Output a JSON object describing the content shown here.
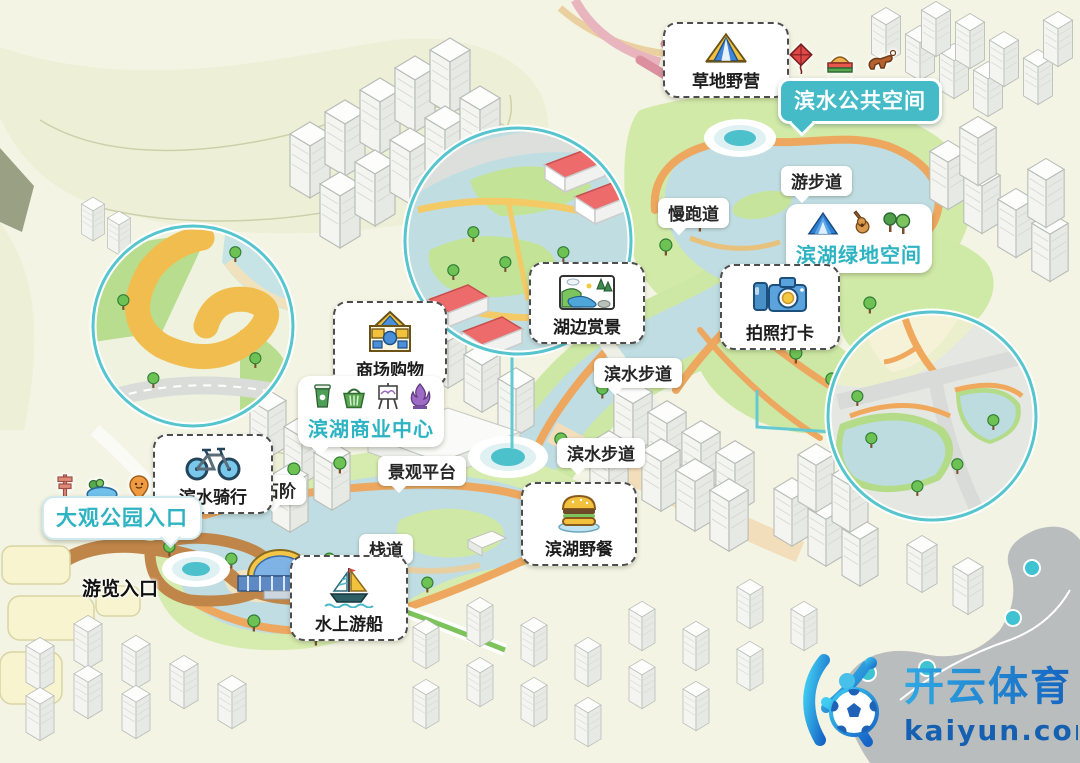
{
  "badges": {
    "public_space": {
      "label": "滨水公共空间"
    },
    "green_space": {
      "label": "滨湖绿地空间"
    },
    "commercial_center": {
      "label": "滨湖商业中心"
    },
    "park_entrance": {
      "label": "大观公园入口"
    }
  },
  "features": {
    "camping": {
      "label": "草地野营"
    },
    "lake_view": {
      "label": "湖边赏景"
    },
    "photo_spot": {
      "label": "拍照打卡"
    },
    "shopping": {
      "label": "商场购物"
    },
    "cycling": {
      "label": "滨水骑行"
    },
    "boat": {
      "label": "水上游船"
    },
    "picnic": {
      "label": "滨湖野餐"
    }
  },
  "paths": {
    "walking_trail": "游步道",
    "jogging_track": "慢跑道",
    "waterfront_walkway_upper": "滨水步道",
    "waterfront_walkway_lower": "滨水步道",
    "stone_steps": "石阶",
    "viewing_platform": "景观平台",
    "boardwalk": "栈道",
    "tour_entrance": "游览入口"
  },
  "watermark": {
    "brand": "开云体育",
    "site": "kaiyun.com"
  },
  "colors": {
    "teal_badge": "#44bbc7",
    "teal_text": "#2db3c2",
    "water": "#bfdde2",
    "path_orange": "#eda75f",
    "green": "#b7dc8d",
    "logo_blue": "#1b7fd4"
  }
}
